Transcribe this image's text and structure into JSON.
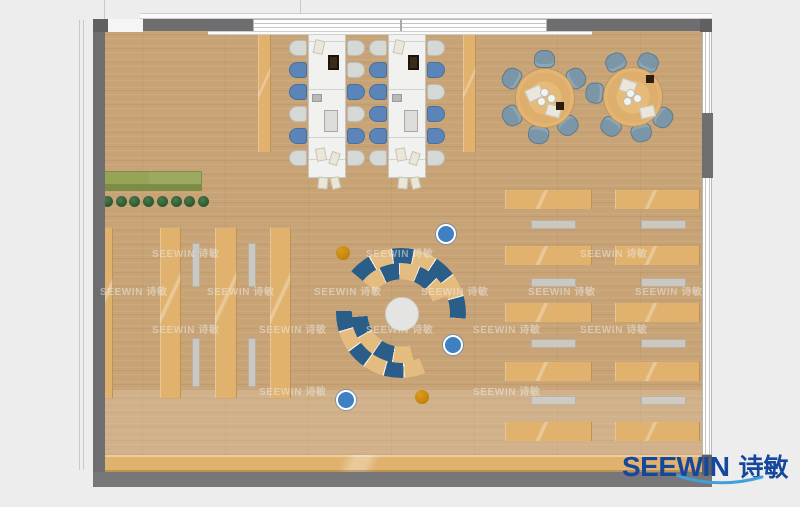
{
  "logo": {
    "en": "SEEWIN",
    "cn": "诗敏"
  },
  "watermark": {
    "text": "SEEWIN 诗敏",
    "positions": [
      [
        100,
        283
      ],
      [
        207,
        283
      ],
      [
        314,
        283
      ],
      [
        421,
        283
      ],
      [
        528,
        283
      ],
      [
        635,
        283
      ],
      [
        152,
        321
      ],
      [
        259,
        321
      ],
      [
        366,
        321
      ],
      [
        473,
        321
      ],
      [
        580,
        321
      ],
      [
        152,
        245
      ],
      [
        366,
        245
      ],
      [
        580,
        245
      ],
      [
        259,
        383
      ],
      [
        473,
        383
      ]
    ]
  },
  "colors": {
    "floor": "#c7a376",
    "wood_tan": "#e0b26e",
    "wall_gray": "#6e6e71",
    "chair_gray": "#d6d8d6",
    "chair_blue": "#5b84b8",
    "chair_steel": "#7b97a7",
    "arc_blue": "#2b5d89",
    "arc_tan": "#e5bc80",
    "stool_blue": "#3f80c2",
    "stool_orange": "#c8870f",
    "plant_green": "#2e5d32",
    "planter_green": "#95a455",
    "logo_blue": "#15479c",
    "swoosh_blue": "#3fa0dc"
  },
  "furniture": {
    "planter": {
      "x": 97,
      "y": 171,
      "w": 105,
      "h": 20
    },
    "plants": {
      "count": 8,
      "x0": 102,
      "dx": 13.7,
      "y": 196,
      "size": 11
    },
    "shelf_zone": {
      "y": 228,
      "h": 170
    },
    "shelf_strips": [
      {
        "x": 97,
        "w": 16
      },
      {
        "x": 160,
        "w": 21
      },
      {
        "x": 215,
        "w": 22
      },
      {
        "x": 270,
        "w": 21
      }
    ],
    "shelf_benches": [
      {
        "x": 192,
        "w": 8
      },
      {
        "x": 248,
        "w": 8
      }
    ],
    "bench_segments": [
      {
        "y": 243,
        "h": 44
      },
      {
        "y": 338,
        "h": 49
      }
    ],
    "side_strips": [
      {
        "x": 258,
        "y": 34,
        "w": 13,
        "h": 118
      },
      {
        "x": 463,
        "y": 34,
        "w": 13,
        "h": 118
      }
    ],
    "long_tables": {
      "xs": [
        308,
        388
      ],
      "y": 33,
      "w": 38,
      "h": 145,
      "seg_offsets": [
        7,
        55,
        103,
        125
      ],
      "chair_y": [
        40,
        62,
        84,
        106,
        128,
        150
      ],
      "chair_w": 18,
      "chair_h": 16,
      "chair_colors": [
        {
          "left": [
            "g",
            "b",
            "b",
            "g",
            "b",
            "g"
          ],
          "right": [
            "g",
            "g",
            "b",
            "g",
            "b",
            "g"
          ]
        },
        {
          "left": [
            "g",
            "b",
            "b",
            "b",
            "b",
            "g"
          ],
          "right": [
            "g",
            "b",
            "g",
            "b",
            "b",
            "g"
          ]
        }
      ],
      "items": [
        {
          "t": "paper",
          "dx": 5,
          "dy": 6,
          "w": 10,
          "h": 14,
          "r": 12
        },
        {
          "t": "laptop",
          "dx": 19,
          "dy": 21,
          "w": 11,
          "h": 15,
          "r": 0
        },
        {
          "t": "tablet",
          "dx": 3,
          "dy": 60,
          "w": 10,
          "h": 8,
          "r": 0
        },
        {
          "t": "monitor",
          "dx": 15,
          "dy": 76,
          "w": 14,
          "h": 22,
          "r": 0
        },
        {
          "t": "paper",
          "dx": 7,
          "dy": 114,
          "w": 10,
          "h": 13,
          "r": -10
        },
        {
          "t": "paper",
          "dx": 21,
          "dy": 118,
          "w": 9,
          "h": 13,
          "r": 18
        },
        {
          "t": "paper",
          "dx": 9,
          "dy": 143,
          "w": 10,
          "h": 12,
          "r": 6
        },
        {
          "t": "paper",
          "dx": 22,
          "dy": 143,
          "w": 9,
          "h": 12,
          "r": -14
        }
      ]
    },
    "round_tables": [
      {
        "cx": 544,
        "cy": 97,
        "r": 29,
        "chair_dist": 38,
        "angles": [
          30,
          90,
          150,
          210,
          262,
          310
        ],
        "papers": [
          {
            "dx": -18,
            "dy": -10,
            "w": 15,
            "h": 11,
            "r": -25
          },
          {
            "dx": 2,
            "dy": 8,
            "w": 13,
            "h": 10,
            "r": 15
          }
        ],
        "cups": [
          [
            -1,
            -6
          ],
          [
            6,
            0
          ],
          [
            -4,
            3
          ]
        ],
        "dark": {
          "dx": 12,
          "dy": 5
        }
      },
      {
        "cx": 632,
        "cy": 96,
        "r": 29,
        "chair_dist": 38,
        "angles": [
          65,
          115,
          175,
          235,
          285,
          325
        ],
        "papers": [
          {
            "dx": -12,
            "dy": -16,
            "w": 14,
            "h": 11,
            "r": 20
          },
          {
            "dx": 8,
            "dy": 10,
            "w": 13,
            "h": 10,
            "r": -12
          }
        ],
        "cups": [
          [
            -3,
            -4
          ],
          [
            4,
            1
          ],
          [
            -6,
            4
          ]
        ],
        "dark": {
          "dx": 14,
          "dy": -21
        }
      }
    ],
    "lounge": {
      "cx": 401,
      "cy": 313,
      "circle_r": 16,
      "arcs": [
        {
          "size": 130,
          "from": 310,
          "span": 145,
          "hole": 75,
          "pattern": [
            "b",
            "t",
            "b",
            "t",
            "b",
            "t",
            "b"
          ]
        },
        {
          "size": 100,
          "from": 310,
          "span": 120,
          "hole": 67,
          "pattern": [
            "t",
            "b",
            "t",
            "b",
            "t"
          ]
        },
        {
          "size": 130,
          "from": 158,
          "span": 114,
          "hole": 75,
          "pattern": [
            "t",
            "b",
            "t",
            "b",
            "t",
            "b"
          ]
        },
        {
          "size": 100,
          "from": 165,
          "span": 100,
          "hole": 67,
          "pattern": [
            "t",
            "b",
            "t",
            "b"
          ]
        }
      ],
      "stools": [
        {
          "x": 343,
          "y": 253,
          "c": "orange"
        },
        {
          "x": 444,
          "y": 232,
          "c": "blue"
        },
        {
          "x": 451,
          "y": 343,
          "c": "blue"
        },
        {
          "x": 422,
          "y": 397,
          "c": "orange"
        },
        {
          "x": 344,
          "y": 398,
          "c": "blue"
        }
      ]
    },
    "desks": {
      "cols": [
        {
          "x": 505,
          "w": 87,
          "bx": 531
        },
        {
          "x": 615,
          "w": 85,
          "bx": 641
        }
      ],
      "bench_w": 45,
      "row_y": [
        190,
        246,
        303,
        362,
        422
      ],
      "row_h": 19,
      "bench_y": [
        220,
        278,
        339,
        396
      ],
      "bench_h": 9
    },
    "counter": {
      "x": 103,
      "y": 455,
      "w": 597,
      "h": 17
    }
  }
}
